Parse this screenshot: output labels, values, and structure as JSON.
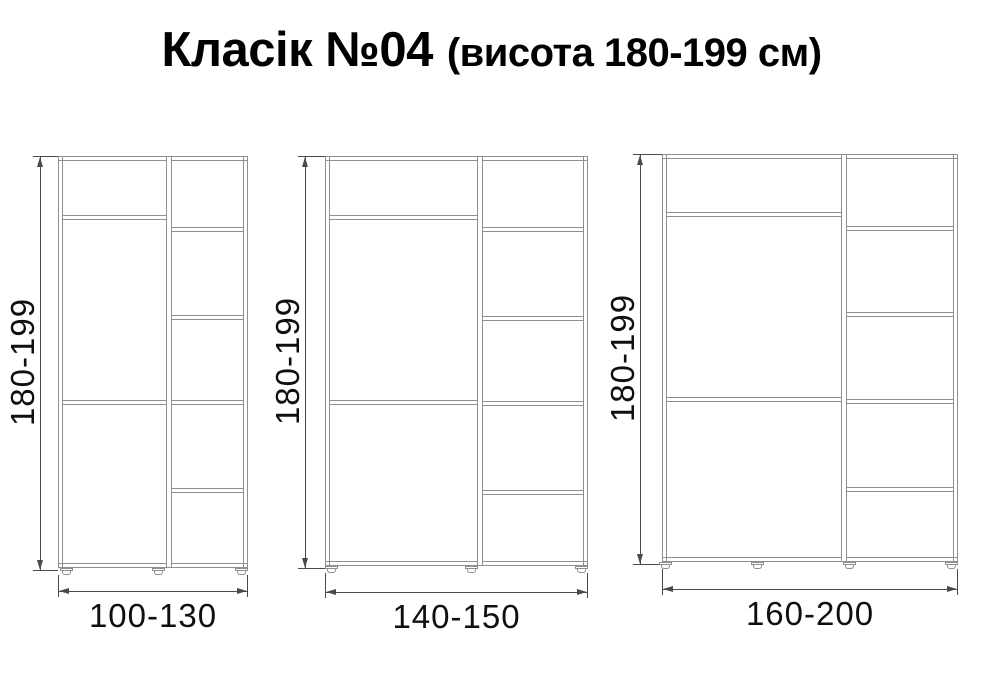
{
  "title": {
    "main": "Класік №04",
    "suffix": "(висота 180-199 см)"
  },
  "colors": {
    "panel_line": "#8f8f8f",
    "dim_line": "#4a4a4a",
    "text": "#0f0f0f"
  },
  "diagram": {
    "type": "furniture-dimension-drawing",
    "common_height_label": "180-199",
    "cabinets": [
      {
        "id": "wardrobe-100-130",
        "width_label": "100-130",
        "height_label": "180-199",
        "left_compartments": 3,
        "right_compartments": 5,
        "feet_count": 3,
        "geometry": {
          "x": 58,
          "y": 156,
          "w": 190,
          "h": 412,
          "divider_x": 166,
          "left_shelves_y": [
            215,
            400
          ],
          "right_shelves_y": [
            227,
            315,
            400,
            488
          ],
          "feet_cx": [
            66,
            158,
            241
          ],
          "dim_line_x": 40,
          "v_label_offset": -17,
          "h_dim_y": 591
        }
      },
      {
        "id": "wardrobe-140-150",
        "width_label": "140-150",
        "height_label": "180-199",
        "left_compartments": 3,
        "right_compartments": 5,
        "feet_count": 3,
        "geometry": {
          "x": 325,
          "y": 156,
          "w": 263,
          "h": 410,
          "divider_x": 477,
          "left_shelves_y": [
            215,
            400
          ],
          "right_shelves_y": [
            227,
            316,
            401,
            490
          ],
          "feet_cx": [
            331,
            471,
            581
          ],
          "dim_line_x": 305,
          "v_label_offset": -17,
          "h_dim_y": 592
        }
      },
      {
        "id": "wardrobe-160-200",
        "width_label": "160-200",
        "height_label": "180-199",
        "left_compartments": 3,
        "right_compartments": 5,
        "feet_count": 4,
        "geometry": {
          "x": 662,
          "y": 154,
          "w": 296,
          "h": 408,
          "divider_x": 841,
          "left_shelves_y": [
            212,
            397
          ],
          "right_shelves_y": [
            226,
            312,
            399,
            487
          ],
          "feet_cx": [
            665,
            757,
            849,
            951
          ],
          "dim_line_x": 640,
          "v_label_offset": -17,
          "h_dim_y": 589
        }
      }
    ]
  }
}
